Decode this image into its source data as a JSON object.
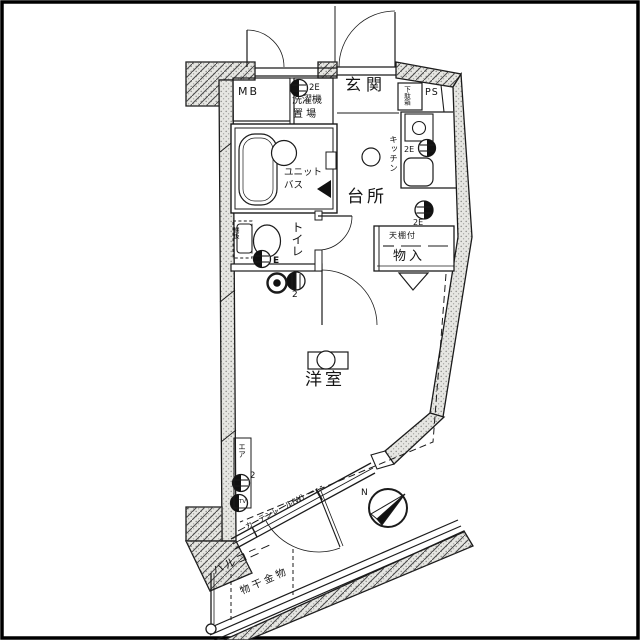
{
  "plan": {
    "labels": {
      "mb": "MB",
      "washer_outlet": "2E",
      "washer_line1": "洗濯機",
      "washer_line2": "置 場",
      "entrance": "玄関",
      "shoe_cabinet": "下駄箱",
      "ps": "PS",
      "kitchen": "キッチン",
      "kitchen_outlet_upper": "2E",
      "kitchen_outlet_lower": "2E",
      "dining": "台所",
      "unit_bath_line1": "ユニット",
      "unit_bath_line2": "バス",
      "toilet": "トイレ",
      "toilet_shelf": "棚板",
      "toilet_outlet": "E",
      "hall_outlet_count": "2",
      "closet_top": "天棚付",
      "closet": "物入",
      "western_room": "洋室",
      "aircon": "エア",
      "aircon_outlet_count": "2",
      "tv_outlet": "TV",
      "curtain_rail": "カーテンレール(W)",
      "balcony": "バルコニー",
      "drying_hardware": "物干金物",
      "compass_north": "N"
    },
    "colors": {
      "line": "#1b1b1b",
      "wall_fill": "#e6e6e2",
      "wall_dot": "#8f8f8c",
      "paper": "#ffffff"
    }
  }
}
